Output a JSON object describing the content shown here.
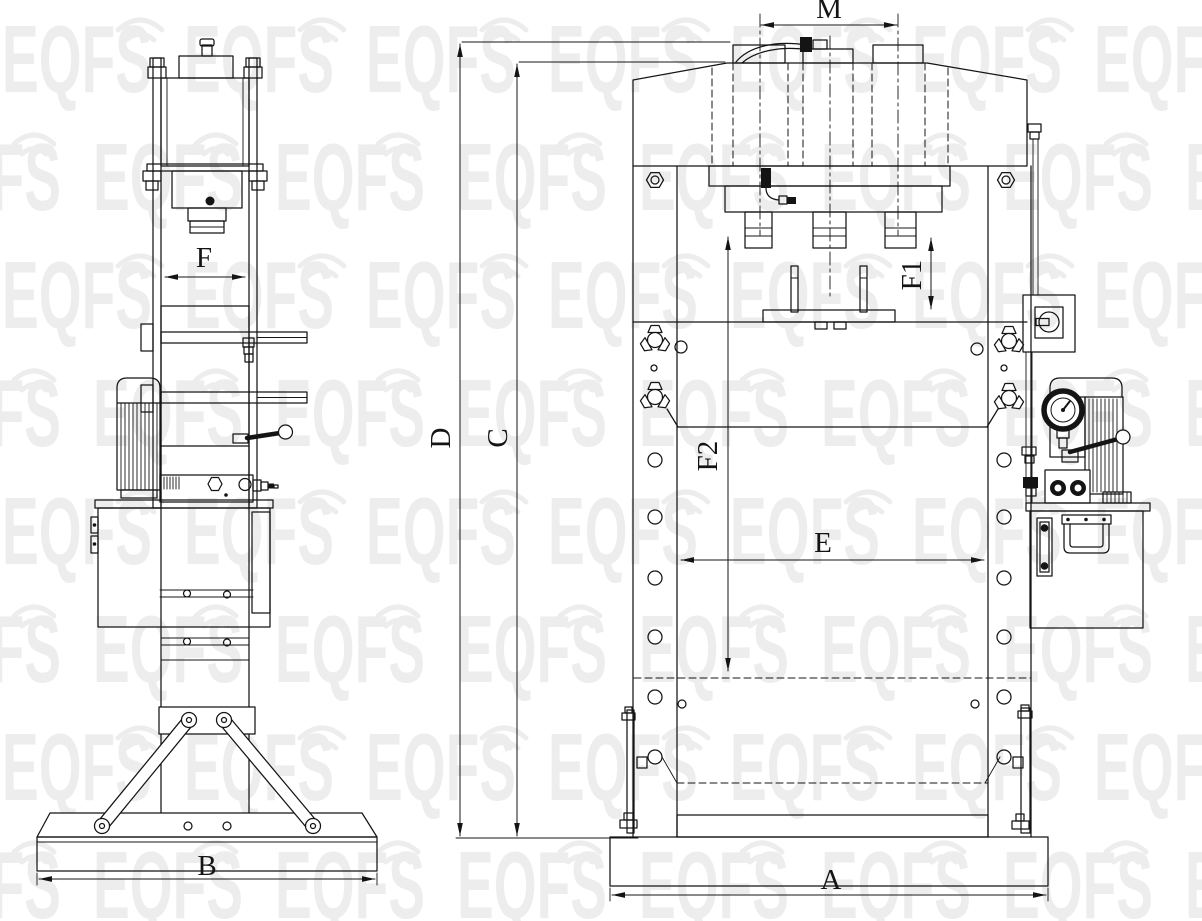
{
  "watermark": {
    "text": "EQFS"
  },
  "colors": {
    "line": "#141414",
    "background": "#ffffff",
    "watermark": "#000000"
  },
  "dims": {
    "M": "M",
    "F": "F",
    "F1": "F1",
    "F2": "F2",
    "E": "E",
    "D": "D",
    "C": "C",
    "B": "B",
    "A": "A"
  }
}
